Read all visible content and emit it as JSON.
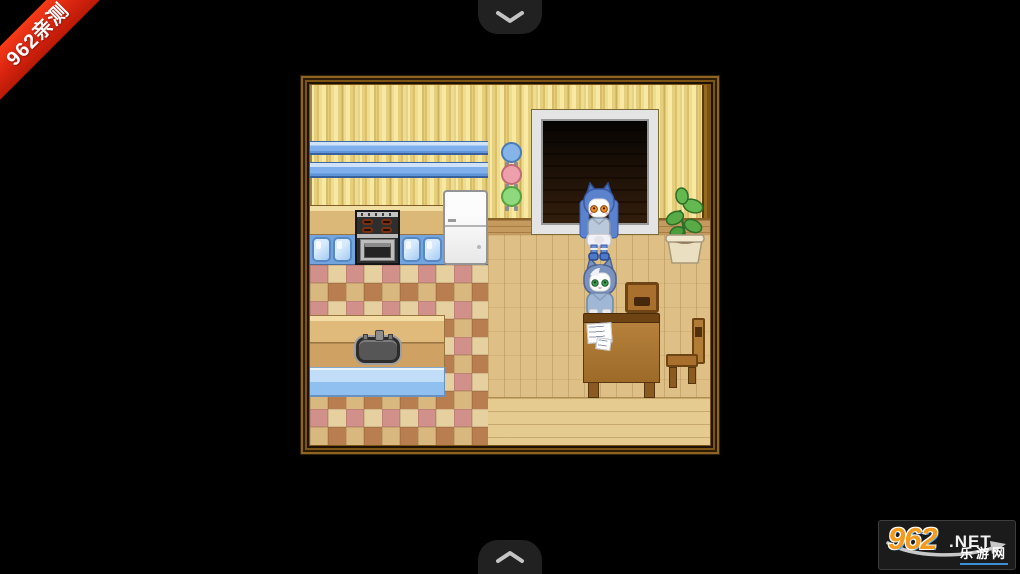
{
  "ribbon": {
    "text": "962亲测",
    "bg_color": "#d82410",
    "text_color": "#ffffff"
  },
  "scroll_tabs": {
    "top_icon": "chevron-down-icon",
    "bottom_icon": "chevron-up-icon",
    "tab_color": "#212121",
    "chevron_color": "#c4c4c4"
  },
  "watermark": {
    "number": "962",
    "tld": ".NET",
    "site_name": "乐游网",
    "number_color": "#f49a1e",
    "accent_color": "#3a8fd8"
  },
  "game": {
    "frame_color": "#7c5414",
    "scene": {
      "room_type": "kitchen-dining-room",
      "wall_plates": [
        "blue",
        "pink",
        "green"
      ],
      "objects": [
        "striped-wallpaper",
        "blue-wall-rails",
        "stove",
        "refrigerator",
        "blue-cabinets",
        "checkered-tile-floor",
        "kitchen-island-with-sink",
        "blue-mat",
        "doorway",
        "potted-plant",
        "wooden-table",
        "papers",
        "dining-chair",
        "side-chair",
        "wood-plank-floor"
      ],
      "characters": [
        {
          "id": "standing-cat",
          "hair": "blue",
          "eyes": "orange",
          "pose": "standing-by-doorway"
        },
        {
          "id": "sitting-cat",
          "hair": "blue-gray",
          "eyes": "green",
          "pose": "sitting-at-table"
        }
      ]
    }
  }
}
